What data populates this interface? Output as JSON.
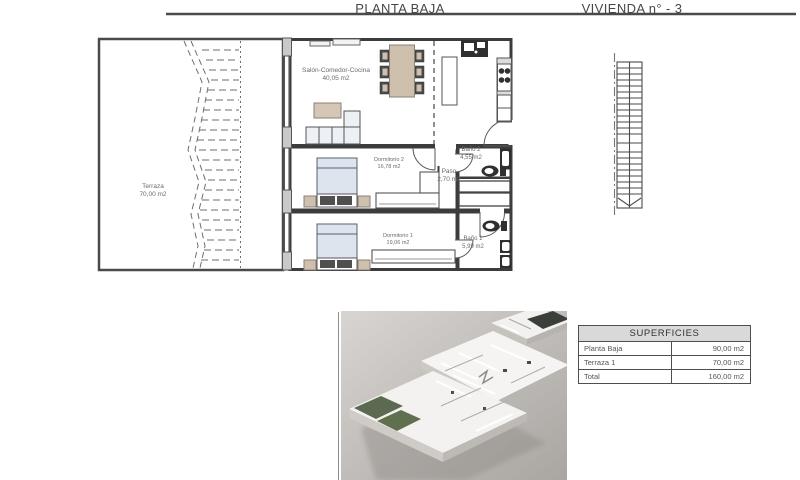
{
  "header": {
    "plan_title": "PLANTA BAJA",
    "unit_title": "VIVIENDA n° - 3"
  },
  "floor_plan": {
    "rooms": [
      {
        "name": "Terraza",
        "area": "70,00 m2"
      },
      {
        "name": "Salón-Comedor-Cocina",
        "area": "40,05 m2"
      },
      {
        "name": "Dormitorio 2",
        "area": "16,78 m2"
      },
      {
        "name": "Paso",
        "area": "2,70 m2"
      },
      {
        "name": "Baño 2",
        "area": "4,55 m2"
      },
      {
        "name": "Dormitorio 1",
        "area": "19,06 m2"
      },
      {
        "name": "Baño 1",
        "area": "5,99 m2"
      }
    ]
  },
  "areas_table": {
    "title": "SUPERFICIES",
    "rows": [
      {
        "label": "Planta Baja",
        "value": "90,00 m2"
      },
      {
        "label": "Terraza 1",
        "value": "70,00 m2"
      },
      {
        "label": "Total",
        "value": "160,00 m2"
      }
    ]
  },
  "colors": {
    "wall": "#3c3c3c",
    "line": "#4a4a4a",
    "pier_fill": "#c9c9c9",
    "wood_furniture": "#cfc0ae",
    "bed_fill": "#dde4ee",
    "dark_fixture": "#2f2f2f",
    "label_text": "#6b6b6b",
    "table_header_bg": "#d9d9d9",
    "photo_bg": "#b5b1ad",
    "terrace_green": "#5c6a51"
  }
}
